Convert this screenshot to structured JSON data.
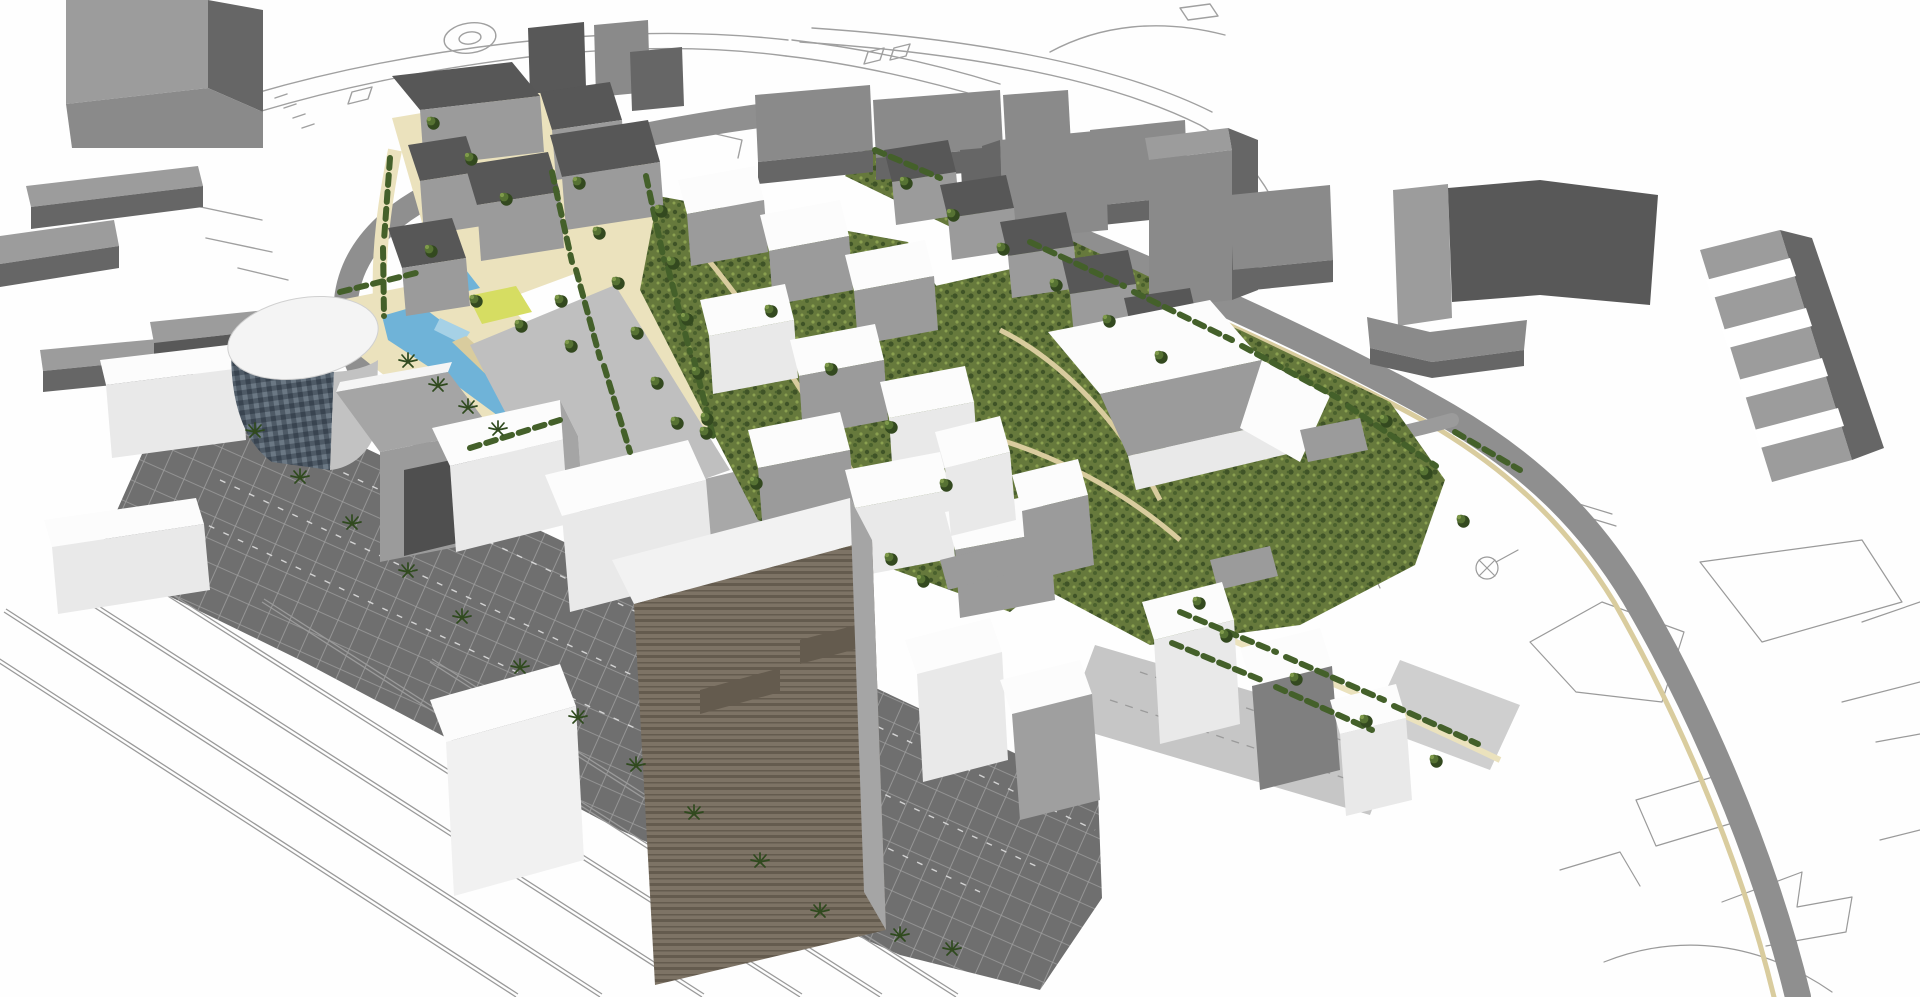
{
  "meta": {
    "width": 1920,
    "height": 997
  },
  "colors": {
    "background": "#fefefe",
    "thin_line": "#a0a0a0",
    "rail_line": "#9a9a9a",
    "road": "#8f8f8f",
    "road_spur": "#9b9b9b",
    "plaza_light": "#c6c6c6",
    "context_top": "#9c9c9c",
    "context_front": "#8a8a8a",
    "context_dark": "#666666",
    "context_slab_dark": "#585858",
    "roof_dark": "#575757",
    "wall_gray": "#9b9b9b",
    "wall_gray_dark": "#7f7f7f",
    "white_top": "#fcfcfc",
    "white_front": "#e9e9e9",
    "white_shade": "#c2c2c2",
    "side_gray": "#a5a5a5",
    "tan": "#ebe2bd",
    "tan_deep": "#d9cc9e",
    "green_base": "#66793c",
    "green_dark": "#3f5327",
    "green_mid": "#4a612d",
    "green_light": "#8aa050",
    "hedge": "#44602a",
    "tree_dark": "#33491f",
    "tree_mid": "#567233",
    "tree_light": "#7f9a4b",
    "palm": "#2f4a1e",
    "water": "#6fb3d8",
    "water_light": "#a6d1e6",
    "lawn": "#d6dd62",
    "glass_base": "#4e5a66",
    "glass_dark": "#394450",
    "glass_light": "#6b7884",
    "plaza_base": "#6f6f6f",
    "plaza_grid": "#9e9e9e",
    "plaza_stripe": "#e6e6e6",
    "brown_base": "#7d7365",
    "brown_dark": "#645b4e"
  },
  "vegetation": {
    "trees": [
      [
        578,
        182
      ],
      [
        598,
        232
      ],
      [
        617,
        282
      ],
      [
        636,
        332
      ],
      [
        656,
        382
      ],
      [
        676,
        422
      ],
      [
        560,
        300
      ],
      [
        570,
        345
      ],
      [
        660,
        210
      ],
      [
        672,
        262
      ],
      [
        686,
        318
      ],
      [
        697,
        372
      ],
      [
        706,
        418
      ],
      [
        432,
        122
      ],
      [
        470,
        158
      ],
      [
        505,
        198
      ],
      [
        430,
        250
      ],
      [
        520,
        325
      ],
      [
        475,
        300
      ],
      [
        905,
        182
      ],
      [
        952,
        214
      ],
      [
        1002,
        248
      ],
      [
        1055,
        284
      ],
      [
        1108,
        320
      ],
      [
        1160,
        356
      ],
      [
        770,
        310
      ],
      [
        830,
        368
      ],
      [
        890,
        426
      ],
      [
        945,
        484
      ],
      [
        755,
        482
      ],
      [
        705,
        432
      ],
      [
        1225,
        635
      ],
      [
        1295,
        678
      ],
      [
        1365,
        720
      ],
      [
        1435,
        760
      ],
      [
        1198,
        602
      ],
      [
        1385,
        420
      ],
      [
        1425,
        472
      ],
      [
        1462,
        520
      ],
      [
        890,
        558
      ],
      [
        922,
        580
      ]
    ],
    "palms": [
      [
        255,
        432
      ],
      [
        300,
        478
      ],
      [
        352,
        524
      ],
      [
        408,
        572
      ],
      [
        462,
        618
      ],
      [
        520,
        668
      ],
      [
        578,
        718
      ],
      [
        636,
        766
      ],
      [
        694,
        814
      ],
      [
        408,
        362
      ],
      [
        438,
        386
      ],
      [
        468,
        408
      ],
      [
        498,
        430
      ],
      [
        760,
        862
      ],
      [
        820,
        912
      ],
      [
        900,
        936
      ],
      [
        952,
        950
      ]
    ],
    "hedges": [
      [
        552,
        172,
        572,
        262
      ],
      [
        576,
        270,
        600,
        358
      ],
      [
        604,
        366,
        630,
        452
      ],
      [
        646,
        176,
        664,
        260
      ],
      [
        668,
        268,
        690,
        352
      ],
      [
        694,
        360,
        714,
        440
      ],
      [
        390,
        158,
        384,
        240
      ],
      [
        383,
        248,
        384,
        316
      ],
      [
        340,
        292,
        420,
        272
      ],
      [
        470,
        448,
        560,
        420
      ],
      [
        1030,
        242,
        1124,
        286
      ],
      [
        1134,
        292,
        1232,
        340
      ],
      [
        1242,
        346,
        1338,
        398
      ],
      [
        1348,
        406,
        1436,
        466
      ],
      [
        1180,
        612,
        1276,
        652
      ],
      [
        1286,
        657,
        1384,
        700
      ],
      [
        1394,
        706,
        1478,
        744
      ],
      [
        1172,
        643,
        1266,
        682
      ],
      [
        1276,
        687,
        1372,
        730
      ],
      [
        875,
        150,
        940,
        178
      ],
      [
        1455,
        432,
        1520,
        470
      ]
    ]
  },
  "railway": {
    "lines": [
      [
        -30,
        644,
        516,
        997
      ],
      [
        4,
        612,
        600,
        997
      ],
      [
        64,
        588,
        702,
        997
      ],
      [
        152,
        586,
        800,
        997
      ],
      [
        262,
        602,
        880,
        997
      ],
      [
        430,
        662,
        956,
        997
      ]
    ]
  }
}
